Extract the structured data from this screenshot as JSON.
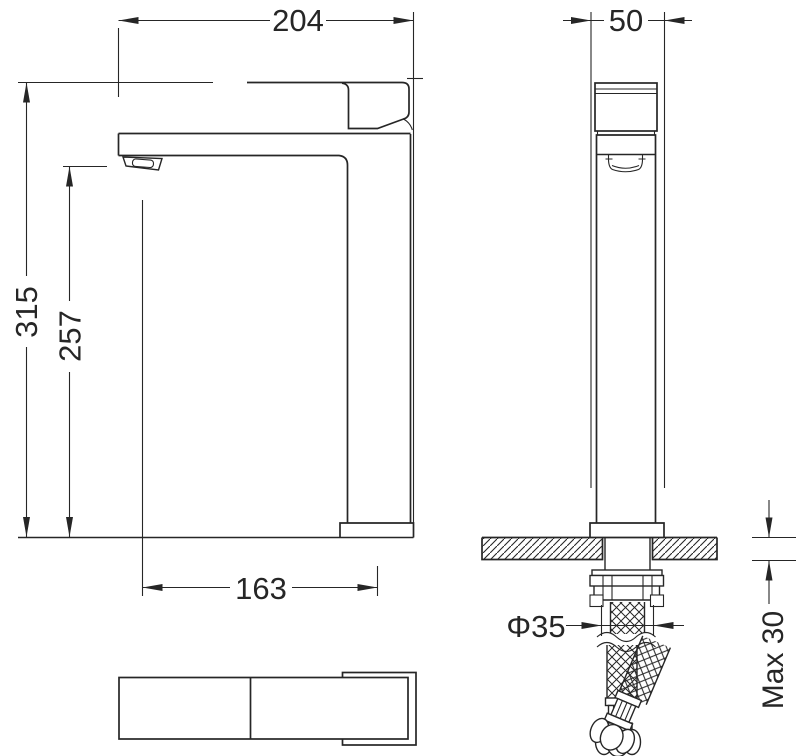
{
  "dimensions": {
    "overall_length": "204",
    "body_width": "50",
    "overall_height": "315",
    "spout_outlet_height": "257",
    "spout_reach": "163",
    "hole_diameter": "Φ35",
    "max_counter_thickness": "Max 30"
  },
  "colors": {
    "line": "#262626",
    "background": "#ffffff"
  }
}
